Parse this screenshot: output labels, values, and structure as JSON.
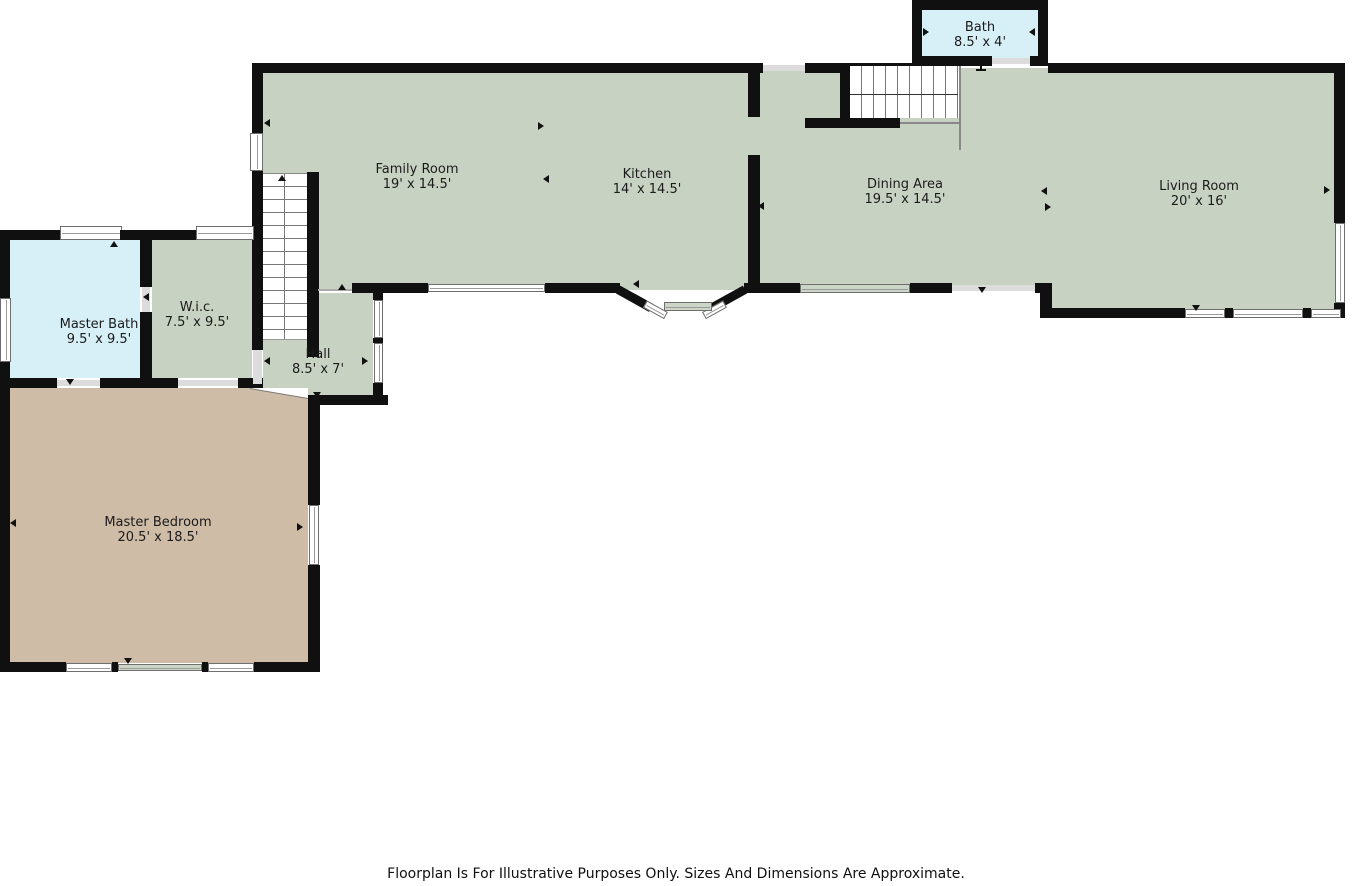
{
  "colors": {
    "room_green": "#c8d2c2",
    "room_blue": "#d7f0f8",
    "room_tan": "#cfbca7",
    "wall_black": "#101010",
    "window_white": "#ffffff",
    "opening_gray": "#dcdcdc"
  },
  "rooms": {
    "bath": {
      "name": "Bath",
      "dims": "8.5' x 4'"
    },
    "family_room": {
      "name": "Family Room",
      "dims": "19' x 14.5'"
    },
    "kitchen": {
      "name": "Kitchen",
      "dims": "14' x 14.5'"
    },
    "dining_area": {
      "name": "Dining Area",
      "dims": "19.5' x 14.5'"
    },
    "living_room": {
      "name": "Living Room",
      "dims": "20' x 16'"
    },
    "master_bath": {
      "name": "Master Bath",
      "dims": "9.5' x 9.5'"
    },
    "wic": {
      "name": "W.i.c.",
      "dims": "7.5' x 9.5'"
    },
    "hall": {
      "name": "Hall",
      "dims": "8.5' x 7'"
    },
    "master_bedroom": {
      "name": "Master Bedroom",
      "dims": "20.5' x 18.5'"
    }
  },
  "footer": {
    "disclaimer": "Floorplan Is For Illustrative Purposes Only. Sizes And Dimensions Are Approximate."
  },
  "icons": {
    "stairs_up_arrow": "triangle-up",
    "stairs_direction_arrow": "triangle-left",
    "door_swing_marker": "small-triangle",
    "door_jamb_marker": "i-beam"
  }
}
